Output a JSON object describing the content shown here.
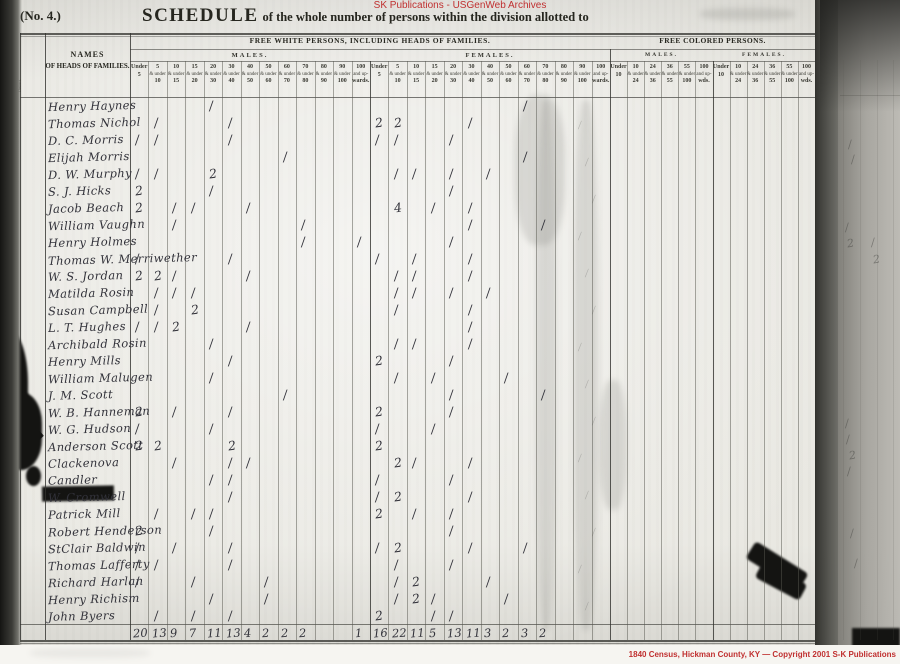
{
  "watermarks": {
    "top": "SK Publications - USGenWeb Archives",
    "bottom": "1840 Census, Hickman County, KY — Copyright 2001 S-K Publications"
  },
  "header": {
    "no_label": "(No. 4.)",
    "schedule_word": "SCHEDULE",
    "schedule_rest": "of the whole number of persons within the division allotted to"
  },
  "table": {
    "side_col_text": "Name of County, City, Ward, Town, Township, Parish, Precinct or District.",
    "names_header_line1": "NAMES",
    "names_header_line2": "OF HEADS OF FAMILIES.",
    "free_white_label": "FREE WHITE PERSONS, INCLUDING HEADS OF FAMILIES.",
    "free_colored_label": "FREE COLORED PERSONS.",
    "males_label": "MALES.",
    "females_label": "FEMALES.",
    "white_age_cols": [
      [
        "Under",
        "5"
      ],
      [
        "5",
        "& under",
        "10"
      ],
      [
        "10",
        "& under",
        "15"
      ],
      [
        "15",
        "& under",
        "20"
      ],
      [
        "20",
        "& under",
        "30"
      ],
      [
        "30",
        "& under",
        "40"
      ],
      [
        "40",
        "& under",
        "50"
      ],
      [
        "50",
        "& under",
        "60"
      ],
      [
        "60",
        "& under",
        "70"
      ],
      [
        "70",
        "& under",
        "80"
      ],
      [
        "80",
        "& under",
        "90"
      ],
      [
        "90",
        "& under",
        "100"
      ],
      [
        "100",
        "and up-",
        "wards."
      ]
    ],
    "colored_age_cols": [
      [
        "Under",
        "10"
      ],
      [
        "10",
        "& under",
        "24"
      ],
      [
        "24",
        "& under",
        "36"
      ],
      [
        "36",
        "& under",
        "55"
      ],
      [
        "55",
        "& under",
        "100"
      ],
      [
        "100",
        "and up-",
        "wds."
      ]
    ]
  },
  "entries": [
    {
      "name": "Henry Haynes",
      "marks": {
        "m4": "1",
        "f8": "1"
      }
    },
    {
      "name": "Thomas Nichol",
      "marks": {
        "m1": "1",
        "m5": "1",
        "f0": "2",
        "f1": "2",
        "f5": "1"
      }
    },
    {
      "name": "D. C. Morris",
      "marks": {
        "m0": "1",
        "m1": "1",
        "m5": "1",
        "f0": "1",
        "f1": "1",
        "f4": "1"
      }
    },
    {
      "name": "Elijah Morris",
      "marks": {
        "m8": "1",
        "f8": "1"
      }
    },
    {
      "name": "D. W. Murphy",
      "marks": {
        "m0": "1",
        "m1": "1",
        "m4": "2",
        "f1": "1",
        "f2": "1",
        "f4": "1",
        "f6": "1"
      }
    },
    {
      "name": "S. J. Hicks",
      "marks": {
        "m0": "2",
        "m4": "1",
        "f4": "1"
      }
    },
    {
      "name": "Jacob Beach",
      "marks": {
        "m0": "2",
        "m2": "1",
        "m3": "1",
        "m6": "1",
        "f1": "4",
        "f3": "1",
        "f5": "1"
      }
    },
    {
      "name": "William Vaughn",
      "marks": {
        "m2": "1",
        "m9": "1",
        "f5": "1",
        "f9": "1"
      }
    },
    {
      "name": "Henry Holmes",
      "marks": {
        "m9": "1",
        "m12": "1",
        "f4": "1"
      }
    },
    {
      "name": "Thomas W. Merriwether",
      "marks": {
        "m0": "1",
        "m5": "1",
        "f0": "1",
        "f2": "1",
        "f5": "1"
      }
    },
    {
      "name": "W. S. Jordan",
      "marks": {
        "m0": "2",
        "m1": "2",
        "m2": "1",
        "m6": "1",
        "f1": "1",
        "f2": "1",
        "f5": "1"
      }
    },
    {
      "name": "Matilda Rosin",
      "marks": {
        "m1": "1",
        "m2": "1",
        "m3": "1",
        "f1": "1",
        "f2": "1",
        "f4": "1",
        "f6": "1"
      }
    },
    {
      "name": "Susan Campbell",
      "marks": {
        "m1": "1",
        "m3": "2",
        "f1": "1",
        "f5": "1"
      }
    },
    {
      "name": "L. T. Hughes",
      "marks": {
        "m0": "1",
        "m1": "1",
        "m2": "2",
        "m6": "1",
        "f5": "1"
      }
    },
    {
      "name": "Archibald Rosin",
      "marks": {
        "m4": "1",
        "f1": "1",
        "f2": "1",
        "f5": "1"
      }
    },
    {
      "name": "Henry Mills",
      "marks": {
        "m5": "1",
        "f0": "2",
        "f4": "1"
      }
    },
    {
      "name": "William Malugen",
      "marks": {
        "m4": "1",
        "f1": "1",
        "f3": "1",
        "f7": "1"
      }
    },
    {
      "name": "J. M. Scott",
      "marks": {
        "m8": "1",
        "f4": "1",
        "f9": "1"
      }
    },
    {
      "name": "W. B. Hanneman",
      "marks": {
        "m0": "2",
        "m2": "1",
        "m5": "1",
        "f0": "2",
        "f4": "1"
      }
    },
    {
      "name": "W. G. Hudson",
      "marks": {
        "m0": "1",
        "m4": "1",
        "f0": "1",
        "f3": "1"
      }
    },
    {
      "name": "Anderson Scott",
      "marks": {
        "m0": "2",
        "m1": "2",
        "m5": "2",
        "f0": "2"
      }
    },
    {
      "name": "Clackenova",
      "marks": {
        "m2": "1",
        "m5": "1",
        "m6": "1",
        "f1": "2",
        "f2": "1",
        "f5": "1"
      }
    },
    {
      "name": "Candler",
      "marks": {
        "m4": "1",
        "m5": "1",
        "f0": "1",
        "f4": "1"
      }
    },
    {
      "name": "W. Cromwell",
      "marks": {
        "m5": "1",
        "f0": "1",
        "f1": "2",
        "f5": "1"
      }
    },
    {
      "name": "Patrick Mill",
      "marks": {
        "m1": "1",
        "m3": "1",
        "m4": "1",
        "f0": "2",
        "f2": "1",
        "f4": "1"
      }
    },
    {
      "name": "Robert Henderson",
      "marks": {
        "m0": "2",
        "m4": "1",
        "f4": "1"
      }
    },
    {
      "name": "StClair Baldwin",
      "marks": {
        "m0": "1",
        "m2": "1",
        "m5": "1",
        "f0": "1",
        "f1": "2",
        "f5": "1",
        "f8": "1"
      }
    },
    {
      "name": "Thomas Lafferty",
      "marks": {
        "m0": "1",
        "m1": "1",
        "m5": "1",
        "f1": "1",
        "f4": "1"
      }
    },
    {
      "name": "Richard Harlan",
      "marks": {
        "m0": "1",
        "m3": "1",
        "m7": "1",
        "f1": "1",
        "f2": "2",
        "f6": "1"
      }
    },
    {
      "name": "Henry Richism",
      "marks": {
        "m4": "1",
        "m7": "1",
        "f1": "1",
        "f2": "2",
        "f3": "1",
        "f7": "1"
      }
    },
    {
      "name": "John Byers",
      "marks": {
        "m1": "1",
        "m3": "1",
        "m5": "1",
        "f0": "2",
        "f3": "1",
        "f4": "1"
      }
    }
  ],
  "totals": {
    "males": [
      "20",
      "13",
      "9",
      "7",
      "11",
      "13",
      "4",
      "2",
      "2",
      "2",
      "",
      "",
      "1"
    ],
    "females": [
      "16",
      "22",
      "11",
      "5",
      "13",
      "11",
      "3",
      "2",
      "3",
      "2",
      "",
      "",
      ""
    ],
    "colored_males": [
      "",
      "",
      "",
      "",
      "",
      ""
    ],
    "colored_females": [
      "",
      "",
      "",
      "",
      "",
      ""
    ]
  },
  "neighbor_page_marks": [
    {
      "x": 848,
      "y": 138,
      "v": "1"
    },
    {
      "x": 851,
      "y": 153,
      "v": "1"
    },
    {
      "x": 845,
      "y": 221,
      "v": "1"
    },
    {
      "x": 847,
      "y": 237,
      "v": "2"
    },
    {
      "x": 871,
      "y": 236,
      "v": "1"
    },
    {
      "x": 873,
      "y": 253,
      "v": "2"
    },
    {
      "x": 845,
      "y": 417,
      "v": "1"
    },
    {
      "x": 846,
      "y": 433,
      "v": "1"
    },
    {
      "x": 849,
      "y": 449,
      "v": "2"
    },
    {
      "x": 847,
      "y": 465,
      "v": "1"
    },
    {
      "x": 850,
      "y": 527,
      "v": "1"
    },
    {
      "x": 854,
      "y": 557,
      "v": "1"
    }
  ]
}
